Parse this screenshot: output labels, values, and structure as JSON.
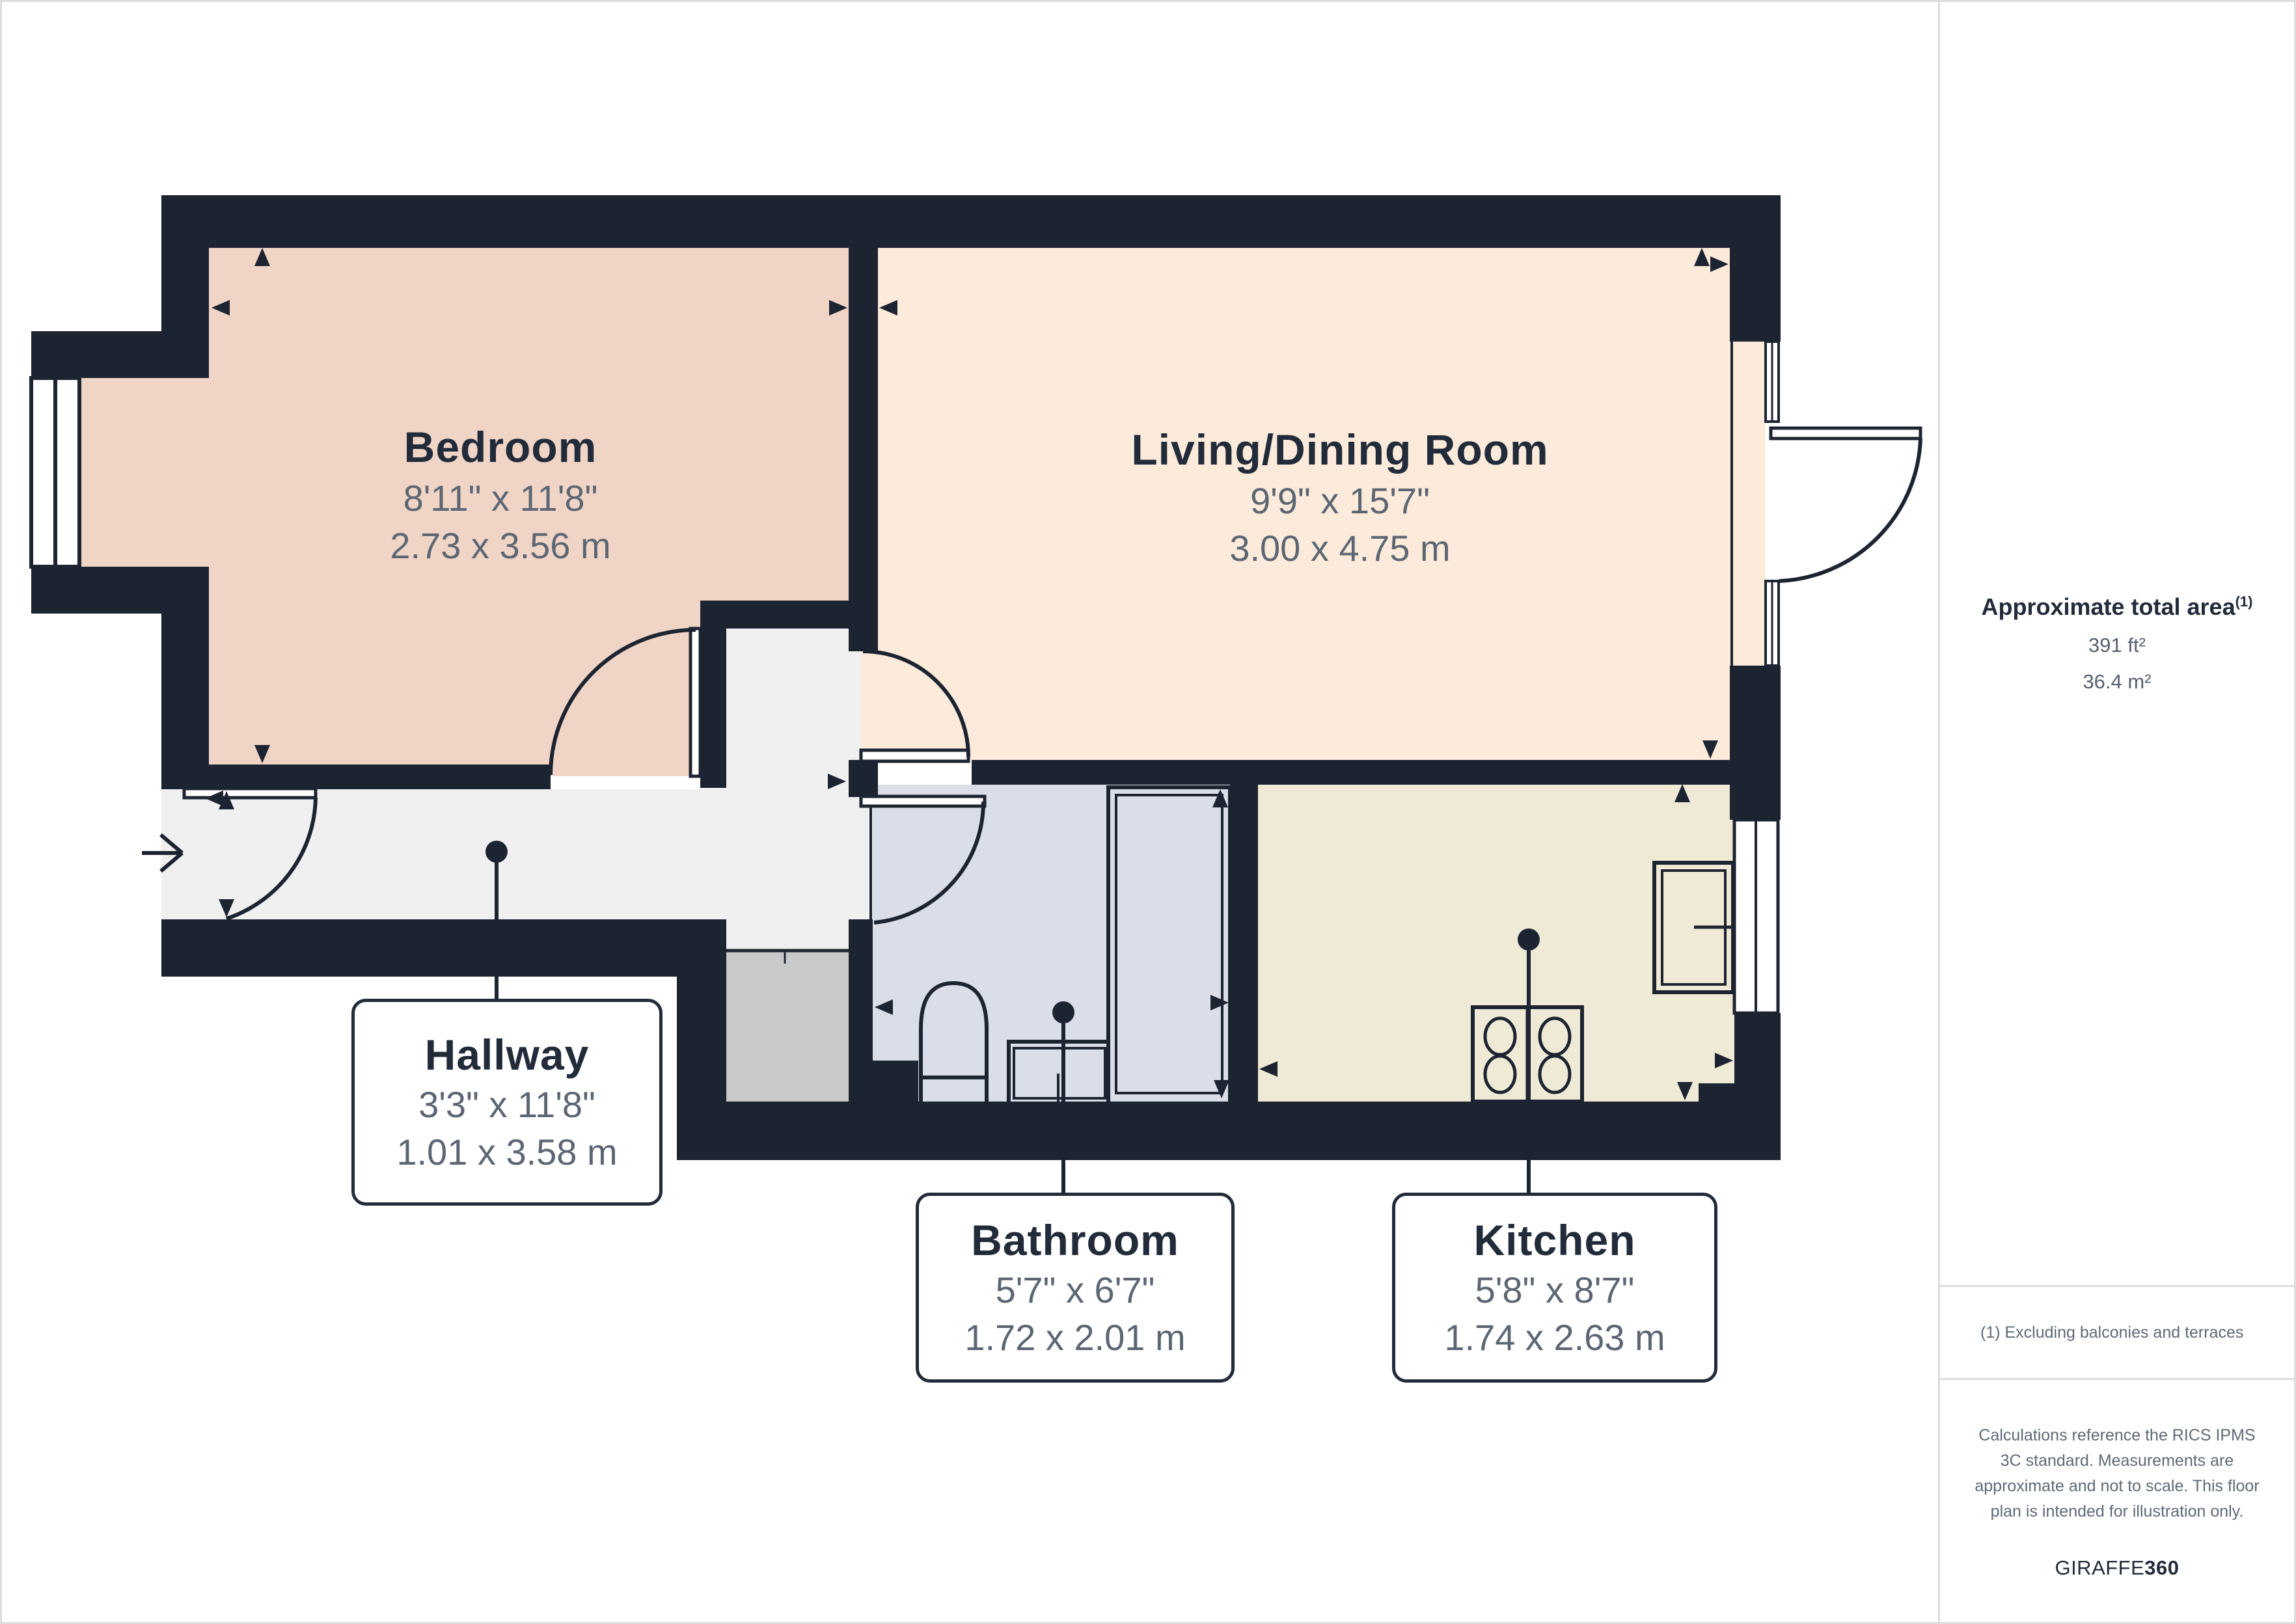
{
  "plan": {
    "rooms": {
      "bedroom": {
        "name": "Bedroom",
        "imperial": "8'11\" x 11'8\"",
        "metric": "2.73 x 3.56 m"
      },
      "living": {
        "name": "Living/Dining Room",
        "imperial": "9'9\" x 15'7\"",
        "metric": "3.00 x 4.75 m"
      },
      "hallway": {
        "name": "Hallway",
        "imperial": "3'3\" x 11'8\"",
        "metric": "1.01 x 3.58 m"
      },
      "bathroom": {
        "name": "Bathroom",
        "imperial": "5'7\" x 6'7\"",
        "metric": "1.72 x 2.01 m"
      },
      "kitchen": {
        "name": "Kitchen",
        "imperial": "5'8\" x 8'7\"",
        "metric": "1.74 x 2.63 m"
      }
    },
    "colors": {
      "wall": "#1d2431",
      "bedroom_floor": "#f0d5c6",
      "living_floor": "#fcebdb",
      "hallway_floor": "#f0f0f1",
      "bathroom_floor": "#d9dee9",
      "kitchen_floor": "#efead6",
      "closet_floor": "#c9c9c9",
      "room_name_text": "#222b39",
      "dimension_text": "#5c6673",
      "divider": "#dcdcdc"
    }
  },
  "sidebar": {
    "total_area_label": "Approximate total area",
    "total_area_footnote_marker": "(1)",
    "total_area_imperial": "391 ft²",
    "total_area_metric": "36.4 m²",
    "footnote": "(1) Excluding balconies and terraces",
    "disclaimer": "Calculations reference the RICS IPMS 3C standard. Measurements are approximate and not to scale. This floor plan is intended for illustration only.",
    "brand_primary": "GIRAFFE",
    "brand_secondary": "360"
  }
}
